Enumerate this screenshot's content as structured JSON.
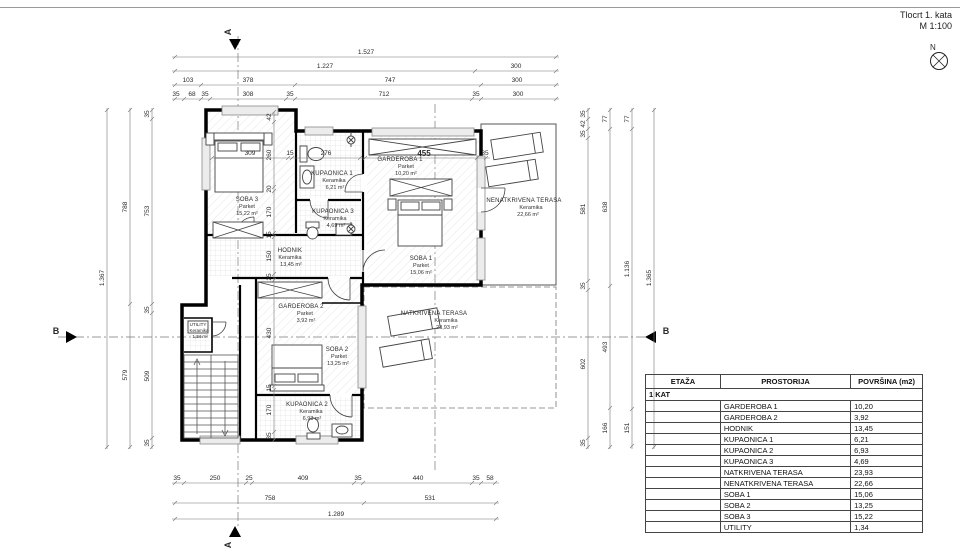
{
  "page": {
    "title_line1": "Tlocrt 1. kata",
    "title_line2": "M 1:100",
    "north_label": "N"
  },
  "markers": {
    "section_a": "A",
    "section_b": "B"
  },
  "dims": {
    "top": {
      "row1": [
        "1.527"
      ],
      "row2": [
        "1.227",
        "300"
      ],
      "row3": [
        "103",
        "378",
        "747",
        "300"
      ],
      "row4": [
        "35",
        "68",
        "35",
        "308",
        "35",
        "712",
        "35",
        "300"
      ]
    },
    "bottom": {
      "row1": [
        "35",
        "250",
        "25",
        "409",
        "35",
        "440",
        "35",
        "58"
      ],
      "row2": [
        "758",
        "531"
      ],
      "row3": [
        "1.289"
      ]
    },
    "left": {
      "col1": [
        "1.367"
      ],
      "col2": [
        "788",
        "579"
      ],
      "col3": [
        "35",
        "753",
        "35",
        "509",
        "35"
      ]
    },
    "right": {
      "col1": [
        "35",
        "42",
        "35",
        "581",
        "35",
        "602",
        "35"
      ],
      "col2": [
        "77",
        "638",
        "493",
        "166"
      ],
      "col3": [
        "77",
        "1.136",
        "151"
      ],
      "col4": [
        "1.365"
      ]
    },
    "interior": {
      "h": [
        "309",
        "15",
        "276",
        "455",
        "35"
      ],
      "v": [
        "42",
        "260",
        "20",
        "170",
        "15",
        "150",
        "25",
        "430",
        "15",
        "170",
        "35"
      ]
    }
  },
  "rooms": {
    "soba3": {
      "name": "SOBA 3",
      "mat": "Parket",
      "area": "15,22 m²"
    },
    "kupaonica1": {
      "name": "KUPAONICA 1",
      "mat": "Keramika",
      "area": "6,21 m²"
    },
    "kupaonica3": {
      "name": "KUPAONICA 3",
      "mat": "Keramika",
      "area": "4,69 m²"
    },
    "garderoba1": {
      "name": "GARDEROBA 1",
      "mat": "Parket",
      "area": "10,20 m²"
    },
    "soba1": {
      "name": "SOBA 1",
      "mat": "Parket",
      "area": "15,06 m²"
    },
    "hodnik": {
      "name": "HODNIK",
      "mat": "Keramika",
      "area": "13,45 m²"
    },
    "garderoba2": {
      "name": "GARDEROBA 2",
      "mat": "Parket",
      "area": "3,92 m²"
    },
    "soba2": {
      "name": "SOBA 2",
      "mat": "Parket",
      "area": "13,25 m²"
    },
    "kupaonica2": {
      "name": "KUPAONICA 2",
      "mat": "Keramika",
      "area": "6,93 m²"
    },
    "utility": {
      "name": "UTILITY",
      "mat": "Keramika",
      "area": "1,34 m²"
    },
    "nenatkrivena_terasa": {
      "name": "NENATKRIVENA TERASA",
      "mat": "Keramika",
      "area": "22,66 m²"
    },
    "natkrivena_terasa": {
      "name": "NATKRIVENA TERASA",
      "mat": "Keramika",
      "area": "23,93 m²"
    }
  },
  "table": {
    "headers": [
      "ETAŽA",
      "PROSTORIJA",
      "POVRŠINA (m2)"
    ],
    "floor_label": "1 KAT",
    "rows": [
      [
        "GARDEROBA 1",
        "10,20"
      ],
      [
        "GARDEROBA 2",
        "3,92"
      ],
      [
        "HODNIK",
        "13,45"
      ],
      [
        "KUPAONICA 1",
        "6,21"
      ],
      [
        "KUPAONICA 2",
        "6,93"
      ],
      [
        "KUPAONICA 3",
        "4,69"
      ],
      [
        "NATKRIVENA TERASA",
        "23,93"
      ],
      [
        "NENATKRIVENA TERASA",
        "22,66"
      ],
      [
        "SOBA 1",
        "15,06"
      ],
      [
        "SOBA 2",
        "13,25"
      ],
      [
        "SOBA 3",
        "15,22"
      ],
      [
        "UTILITY",
        "1,34"
      ]
    ]
  }
}
